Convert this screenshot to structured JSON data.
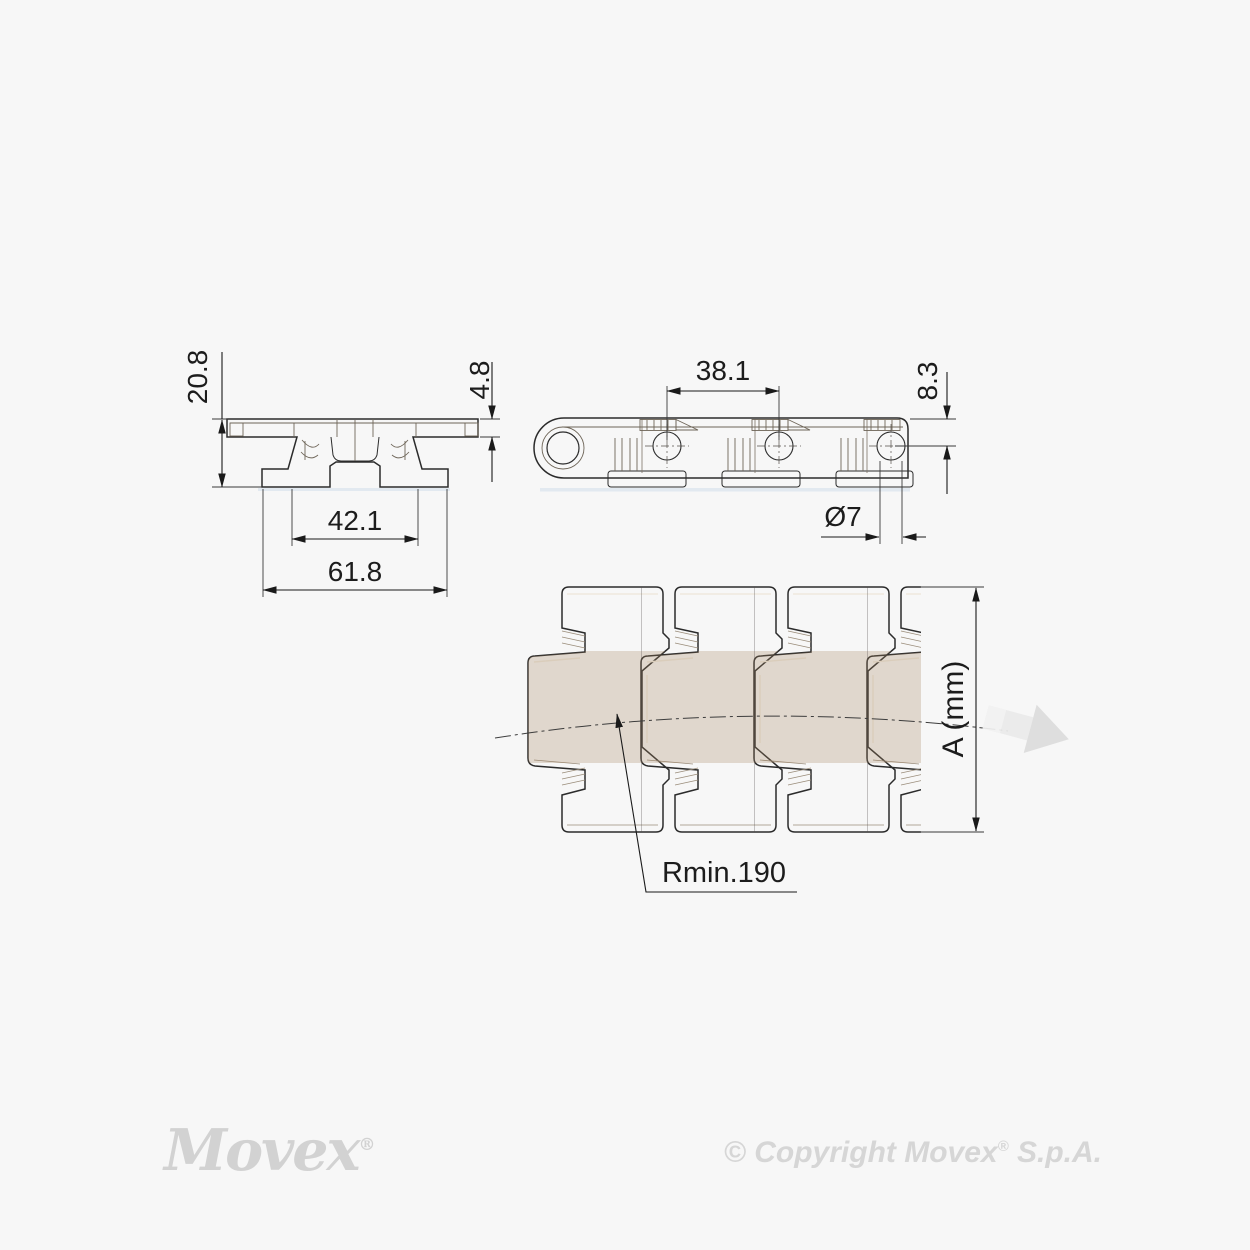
{
  "drawing": {
    "front_view": {
      "overall_height": "20.8",
      "plate_thickness": "4.8",
      "hinge_width": "42.1",
      "overall_width": "61.8"
    },
    "side_view": {
      "pitch": "38.1",
      "pin_center_offset": "8.3",
      "pin_diameter": "Ø7"
    },
    "plan_view": {
      "chain_width_label": "A (mm)",
      "min_radius_label": "Rmin.190"
    },
    "colors": {
      "background": "#f7f7f7",
      "part_fill_light": "#e2dacd",
      "part_fill_dark": "#cfc3b2",
      "outline": "#2b2b2b",
      "dimension_ink": "#1c1c1c",
      "under_shadow": "#dbe4ee",
      "direction_arrow": "#dcdcdc"
    }
  },
  "footer": {
    "logo_text": "Movex",
    "logo_reg": "®",
    "copyright_prefix": "© Copyright Movex",
    "copyright_reg": "®",
    "copyright_suffix": " S.p.A."
  }
}
